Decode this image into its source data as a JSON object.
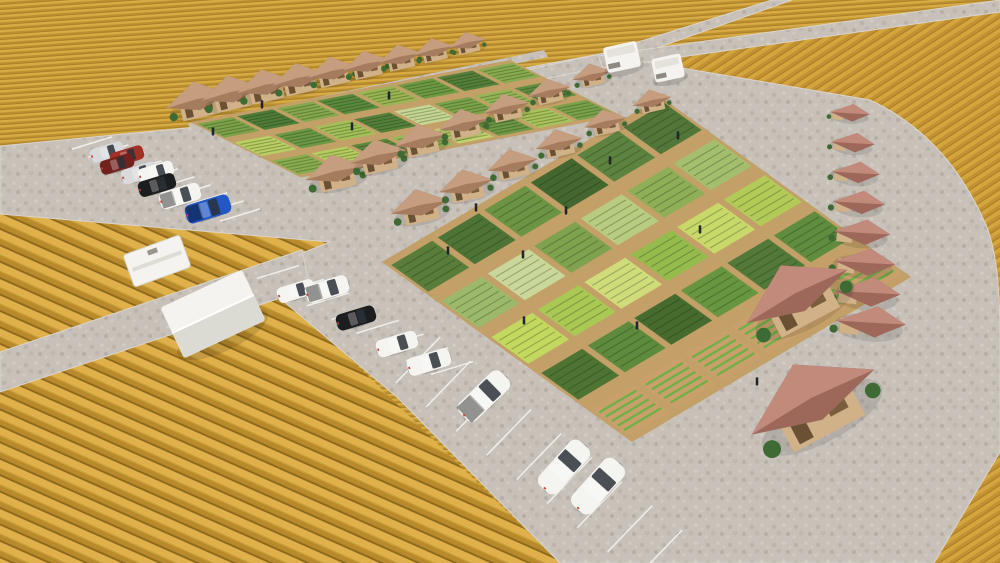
{
  "scene": {
    "type": "3d-aerial-render",
    "subject": "farm cabin community with garden plots, roads and parking amid golden crop fields"
  },
  "palette": {
    "field_light": "#D8AB44",
    "field_dark": "#BC8F2F",
    "field_row_line": "#8F6A1E",
    "pavement": "#C7C1B9",
    "pavement_light": "#D2CCC3",
    "pavement_dark": "#B6AFA6",
    "plot_border": "#C2A067",
    "soil": "#C9A06B",
    "roof_tan_light": "#C59E7F",
    "roof_tan_dark": "#A67C5F",
    "roof_red_light": "#C18A7A",
    "roof_red_dark": "#9D675A",
    "wall_wood": "#D0B188",
    "wall_accent": "#6B5134",
    "bush": "#3E6B33",
    "crop_row_green": "#6FB049",
    "stall_line": "#F5F4F0",
    "person": "#20262B",
    "vehicle_white": "#F4F4F1",
    "vehicle_silver": "#D9DADC",
    "vehicle_black": "#1C1D1F",
    "vehicle_red": "#A33026",
    "vehicle_darkred": "#71221F",
    "vehicle_blue": "#2257C5",
    "glass": "#2A3138",
    "structure_white": "#F4F3EF"
  },
  "field_regions": [
    {
      "id": "field-top",
      "stripe_angle": -4
    },
    {
      "id": "field-bottom-left",
      "stripe_angle": 24
    },
    {
      "id": "field-right",
      "stripe_angle": -33
    }
  ],
  "blocks": [
    {
      "id": "plot-block-1",
      "origin": [
        190,
        122
      ],
      "u": [
        40,
        -7.75
      ],
      "v": [
        37,
        18.5
      ],
      "cols": 8,
      "rows": 3,
      "soil_row": -1,
      "colors": [
        [
          "#7DA24A",
          "#4F7C38",
          "#86A84E",
          "#5B8A3E",
          "#9AB553",
          "#6F9A44",
          "#557F3A",
          "#8AAB50"
        ],
        [
          "#B9CF63",
          "#6D9845",
          "#A2C058",
          "#54803B",
          "#C6D795",
          "#7CA34A",
          "#95B556",
          "#628C40"
        ],
        [
          "#89AD4F",
          "#B5CC61",
          "#5D873E",
          "#97B857",
          "#C0D36E",
          "#6E9846",
          "#A9C35C",
          "#7BA24B"
        ]
      ]
    },
    {
      "id": "plot-block-2",
      "origin": [
        382,
        262
      ],
      "u": [
        46.5,
        -27.5
      ],
      "v": [
        50,
        36
      ],
      "cols": 6,
      "rows": 5,
      "soil_row": 4,
      "colors": [
        [
          "#5A7D3B",
          "#4E7336",
          "#6B9444",
          "#43672F",
          "#5D8340",
          "#52763A"
        ],
        [
          "#9CB96B",
          "#C9D79A",
          "#7FA24F",
          "#B7CC80",
          "#8FAE58",
          "#A3BF6E"
        ],
        [
          "#C3D85E",
          "#A9C854",
          "#D0DC7A",
          "#95BB4D",
          "#C8D96A",
          "#B2CB58"
        ],
        [
          "#4E7434",
          "#5D8A3D",
          "#456B2F",
          "#68953F",
          "#52793A",
          "#5F8C3E"
        ],
        [
          "#C9A06B",
          "#C9A06B",
          "#C9A06B",
          "#C9A06B",
          "#C9A06B",
          "#C9A06B"
        ]
      ]
    }
  ],
  "houses": {
    "total": 32,
    "rows": [
      {
        "id": "cabin-row-top",
        "count": 9,
        "from": [
          198,
          102
        ],
        "to": [
          468,
          44
        ],
        "size": [
          52,
          30
        ],
        "style": "cabin",
        "rot": -13,
        "roof": "tan"
      },
      {
        "id": "cabin-row-middle-upper",
        "count": 7,
        "from": [
          336,
          174
        ],
        "to": [
          592,
          76
        ],
        "size": [
          50,
          32
        ],
        "style": "cabin",
        "rot": -13,
        "roof": "tan"
      },
      {
        "id": "cabin-row-middle-lower",
        "count": 6,
        "from": [
          420,
          208
        ],
        "to": [
          652,
          102
        ],
        "size": [
          48,
          32
        ],
        "style": "cabin",
        "rot": -13,
        "roof": "tan"
      },
      {
        "id": "house-column-right",
        "count": 8,
        "from": [
          854,
          114
        ],
        "to": [
          878,
          324
        ],
        "size": [
          26,
          46
        ],
        "style": "gable",
        "rot": 6,
        "roof": "red"
      },
      {
        "id": "house-row-bottom-right",
        "count": 2,
        "from": [
          798,
          298
        ],
        "to": [
          814,
          404
        ],
        "size": [
          92,
          112
        ],
        "style": "big",
        "rot": -28,
        "roof": "red"
      }
    ]
  },
  "parking": {
    "stall_rows": [
      {
        "id": "stalls-left",
        "from": [
          92,
          143
        ],
        "to": [
          240,
          215
        ],
        "count": 9,
        "len": 42,
        "angle": -17
      },
      {
        "id": "stalls-center",
        "from": [
          278,
          272
        ],
        "to": [
          452,
          368
        ],
        "count": 7,
        "len": 44,
        "angle": -17
      },
      {
        "id": "stalls-bottom",
        "from": [
          418,
          360
        ],
        "to": [
          660,
          553
        ],
        "count": 8,
        "len": 64,
        "angle": -46
      }
    ]
  },
  "vehicles": {
    "cars": [
      {
        "x": 107,
        "y": 152,
        "len": 34,
        "rot": -17,
        "color": "silver",
        "type": "suv"
      },
      {
        "x": 127,
        "y": 156,
        "len": 34,
        "rot": -17,
        "color": "red",
        "type": "suv"
      },
      {
        "x": 117,
        "y": 164,
        "len": 34,
        "rot": -17,
        "color": "darkred",
        "type": "sedan"
      },
      {
        "x": 139,
        "y": 173,
        "len": 36,
        "rot": -17,
        "color": "silver",
        "type": "sedan"
      },
      {
        "x": 156,
        "y": 172,
        "len": 36,
        "rot": -17,
        "color": "white",
        "type": "sedan"
      },
      {
        "x": 157,
        "y": 185,
        "len": 38,
        "rot": -17,
        "color": "black",
        "type": "suv"
      },
      {
        "x": 180,
        "y": 196,
        "len": 42,
        "rot": -17,
        "color": "white",
        "type": "pickup"
      },
      {
        "x": 208,
        "y": 209,
        "len": 46,
        "rot": -17,
        "color": "blue",
        "type": "pickup"
      },
      {
        "x": 296,
        "y": 291,
        "len": 38,
        "rot": -17,
        "color": "white",
        "type": "sedan"
      },
      {
        "x": 327,
        "y": 289,
        "len": 44,
        "rot": -17,
        "color": "white",
        "type": "pickup"
      },
      {
        "x": 356,
        "y": 318,
        "len": 40,
        "rot": -17,
        "color": "black",
        "type": "sedan"
      },
      {
        "x": 397,
        "y": 344,
        "len": 42,
        "rot": -17,
        "color": "white",
        "type": "van"
      },
      {
        "x": 429,
        "y": 362,
        "len": 44,
        "rot": -17,
        "color": "white",
        "type": "van"
      },
      {
        "x": 484,
        "y": 396,
        "len": 58,
        "rot": -44,
        "color": "white",
        "type": "pickup"
      },
      {
        "x": 564,
        "y": 467,
        "len": 60,
        "rot": -48,
        "color": "white",
        "type": "sedan"
      },
      {
        "x": 598,
        "y": 486,
        "len": 62,
        "rot": -48,
        "color": "white",
        "type": "suv"
      }
    ],
    "rvs": [
      {
        "x": 622,
        "y": 57,
        "w": 34,
        "h": 26,
        "rot": -12
      },
      {
        "x": 668,
        "y": 68,
        "w": 30,
        "h": 24,
        "rot": -12
      }
    ],
    "trailer": {
      "x": 157,
      "y": 261,
      "w": 60,
      "h": 34,
      "rot": -20
    }
  },
  "structures": {
    "tent": {
      "x": 213,
      "y": 314,
      "w": 90,
      "h": 56,
      "rot": -25
    }
  },
  "people": {
    "count": 14,
    "positions": [
      [
        213,
        133
      ],
      [
        262,
        106
      ],
      [
        352,
        128
      ],
      [
        389,
        97
      ],
      [
        448,
        252
      ],
      [
        476,
        209
      ],
      [
        523,
        256
      ],
      [
        566,
        212
      ],
      [
        610,
        162
      ],
      [
        637,
        327
      ],
      [
        700,
        231
      ],
      [
        757,
        383
      ],
      [
        524,
        322
      ],
      [
        678,
        137
      ]
    ]
  }
}
